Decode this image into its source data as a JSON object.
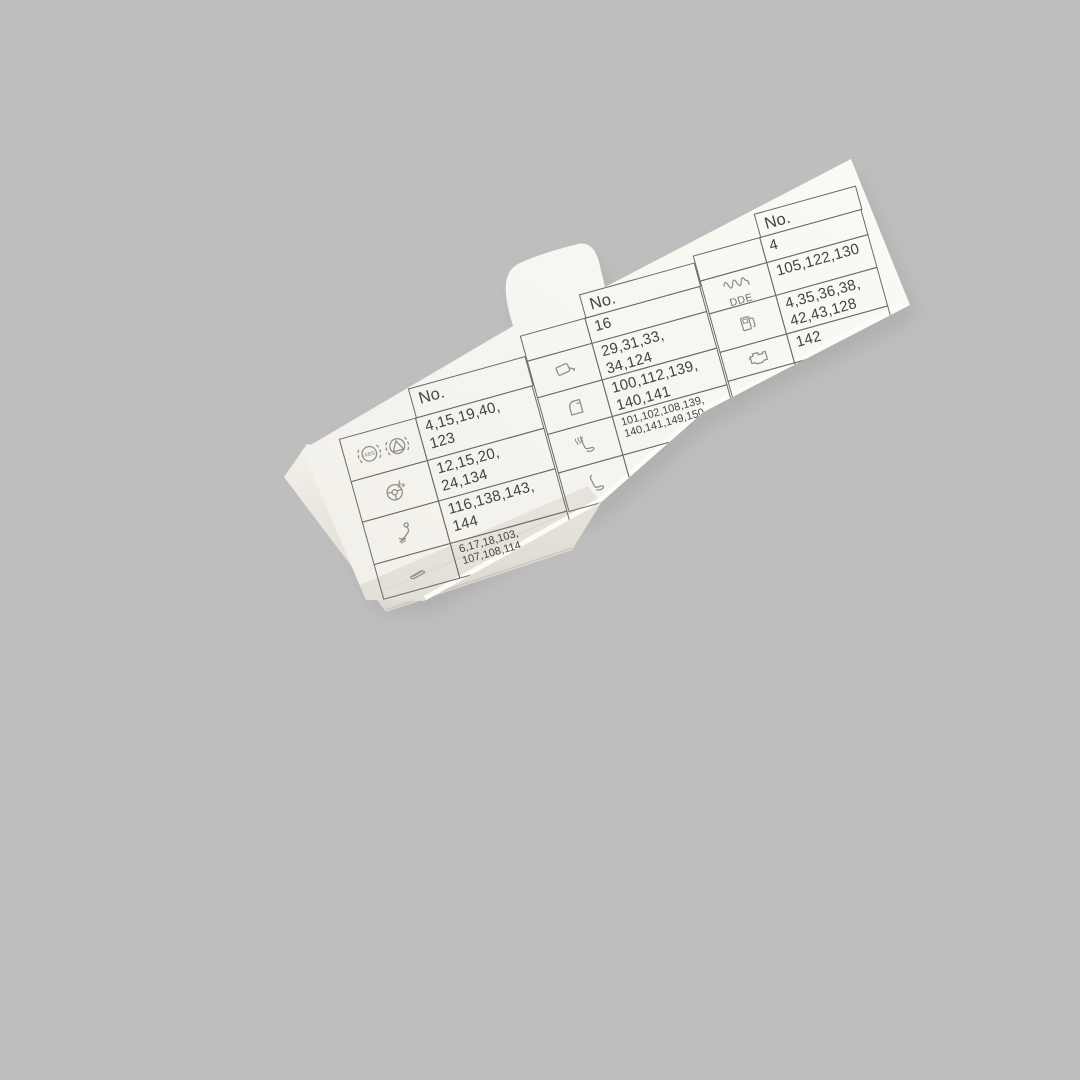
{
  "scene": {
    "background_color": "#bebebe",
    "card_color": "#f7f5f0",
    "line_color": "#6b6a63",
    "text_color": "#44433e",
    "icon_color": "#8f8e86",
    "description": "white fuse assignment card photographed on gray background"
  },
  "table": {
    "header_label": "No.",
    "groups": [
      {
        "rows": [
          {
            "icons": [
              "abs",
              "traction-control"
            ],
            "numbers": "4,15,19,40,\n123"
          },
          {
            "icons": [
              "steering-wheel"
            ],
            "numbers": "12,15,20,\n24,134"
          },
          {
            "icons": [
              "towbar"
            ],
            "numbers": "116,138,143,\n144"
          },
          {
            "icons": [
              "cigarette-lighter"
            ],
            "numbers": "6,17,18,103,\n107,108,114,",
            "small": true
          }
        ]
      },
      {
        "rows": [
          {
            "icons": [],
            "numbers": "16"
          },
          {
            "icons": [
              "mirror"
            ],
            "numbers": "29,31,33,\n34,124"
          },
          {
            "icons": [
              "door"
            ],
            "numbers": "100,112,139,\n140,141"
          },
          {
            "icons": [
              "heated-seat"
            ],
            "numbers": "101,102,108,139,\n140,141,149,150",
            "small": true
          },
          {
            "icons": [
              "seat"
            ],
            "numbers": ""
          }
        ]
      },
      {
        "rows": [
          {
            "icons": [],
            "numbers": "4"
          },
          {
            "icons": [
              "glow-plug"
            ],
            "icon_label": "DDE",
            "numbers": "105,122,130"
          },
          {
            "icons": [
              "fuel-pump"
            ],
            "numbers": "4,35,36,38,\n42,43,128"
          },
          {
            "icons": [
              "engine"
            ],
            "numbers": "142"
          },
          {
            "icons": [
              "antenna"
            ],
            "icon_text_left": "N",
            "icon_text_right": "JAP",
            "numbers": ""
          }
        ]
      }
    ]
  }
}
